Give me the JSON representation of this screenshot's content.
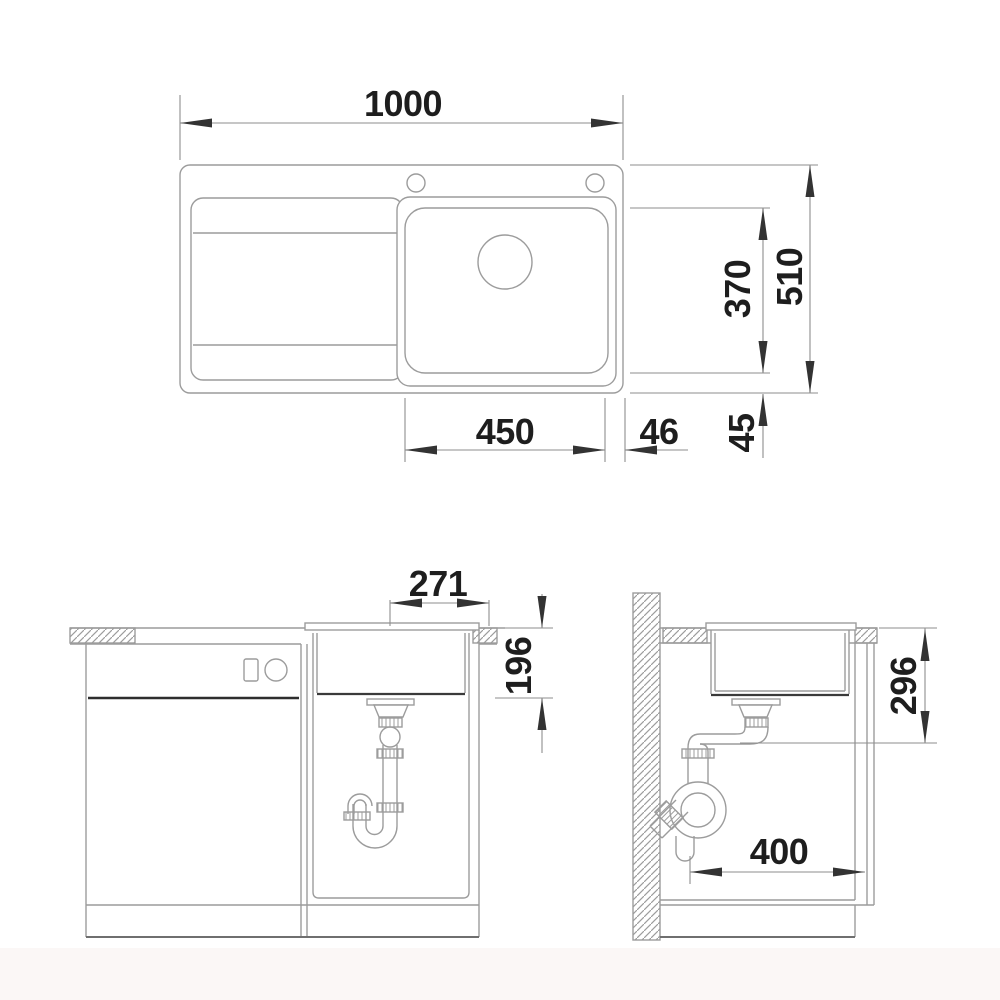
{
  "drawing_title": "Sink installation dimension drawing",
  "style": {
    "line_color": "#9c9c9c",
    "dark_line_color": "#2e2e2e",
    "dim_line_color": "#8e8e8e",
    "arrow_color": "#333333",
    "text_color": "#1e1e1e",
    "background": "#ffffff"
  },
  "dimensions": {
    "overall_width": "1000",
    "overall_depth": "510",
    "bowl_depth_front_back": "370",
    "bowl_width": "450",
    "bowl_to_right_edge": "46",
    "bowl_to_front_edge": "45",
    "drain_offset": "271",
    "bowl_height": "196",
    "outlet_height": "296",
    "cabinet_depth": "400"
  }
}
